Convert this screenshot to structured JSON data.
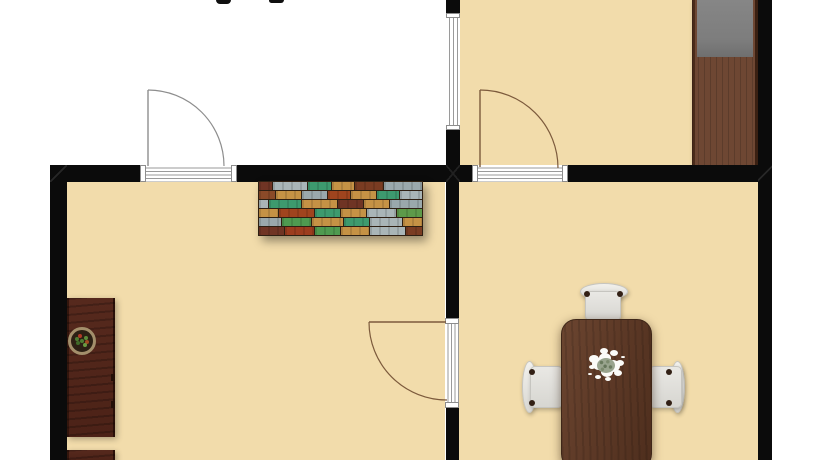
{
  "meta": {
    "description": "Top-down 2D architectural floor plan rendering, cropped at the top and bottom edges",
    "label_note": "only two tiny descender fragments of a cropped room-label text are visible at the very top edge"
  },
  "colors": {
    "background": "#ffffff",
    "floor": "#f2dcab",
    "wall": "#0b0b0b",
    "door-line-gray": "#8d8d8d",
    "door-line-brown": "#7c5a3c",
    "threshold-line": "#9a9a9a",
    "wardrobe-body": "#6e4733",
    "wardrobe-top": "#7d7d7d",
    "cabinet": "#56291d",
    "table": "#5e3a27",
    "table-edge": "#3f2718",
    "chair-edge": "#c6c5c0",
    "chair-dot": "#322015",
    "plant-rim": "#a38f6b",
    "plant-soil": "#2c2014",
    "centerpiece-white": "#fbfbf8",
    "centerpiece-core": "#99a48e"
  },
  "rooms": [
    {
      "id": "top-left-room",
      "floor": "white",
      "contents": []
    },
    {
      "id": "top-right-room",
      "floor": "tan",
      "contents": [
        "wardrobe"
      ]
    },
    {
      "id": "bottom-left-room",
      "floor": "tan",
      "contents": [
        "multicolor-sideboard",
        "tall-cabinet",
        "potted-plant",
        "lower-cabinet"
      ]
    },
    {
      "id": "bottom-right-room",
      "floor": "tan",
      "contents": [
        "dining-table",
        "three-chairs",
        "flower-centerpiece"
      ]
    }
  ],
  "openings": {
    "doors": [
      {
        "id": "door-top-left",
        "wall": "middle-horizontal-wall",
        "swing": "opens up into white room"
      },
      {
        "id": "door-top-right",
        "wall": "middle-horizontal-wall",
        "swing": "opens up into top-right room"
      },
      {
        "id": "door-bottom-middle",
        "wall": "vertical-divider-wall",
        "swing": "opens left into bottom-left room"
      }
    ],
    "windows": [
      {
        "id": "window-upper-divider",
        "wall": "upper-vertical-divider-wall"
      }
    ]
  },
  "furniture": {
    "wardrobe": {
      "room": "top-right-room",
      "style": "dark wood with gray top panel, flush against right wall"
    },
    "sideboard": {
      "room": "bottom-left-room",
      "style": "reclaimed multicolor wood planks, against middle wall",
      "plank_rows": [
        [
          {
            "c": "#6f3424",
            "w": 8
          },
          {
            "c": "#a9b5b7",
            "w": 22
          },
          {
            "c": "#3d9a6e",
            "w": 14
          },
          {
            "c": "#c59245",
            "w": 14
          },
          {
            "c": "#7a3c22",
            "w": 18
          },
          {
            "c": "#9aa8ac",
            "w": 24
          }
        ],
        [
          {
            "c": "#8a4a28",
            "w": 10
          },
          {
            "c": "#c59245",
            "w": 16
          },
          {
            "c": "#9aa8ac",
            "w": 16
          },
          {
            "c": "#a0441e",
            "w": 14
          },
          {
            "c": "#c59245",
            "w": 16
          },
          {
            "c": "#3d9a6e",
            "w": 14
          },
          {
            "c": "#a9b5b7",
            "w": 14
          }
        ],
        [
          {
            "c": "#a9b5b7",
            "w": 6
          },
          {
            "c": "#3d9a6e",
            "w": 20
          },
          {
            "c": "#c59245",
            "w": 22
          },
          {
            "c": "#6f3424",
            "w": 16
          },
          {
            "c": "#c59245",
            "w": 16
          },
          {
            "c": "#9aa8ac",
            "w": 20
          }
        ],
        [
          {
            "c": "#c59245",
            "w": 12
          },
          {
            "c": "#a0441e",
            "w": 22
          },
          {
            "c": "#3d9a6e",
            "w": 16
          },
          {
            "c": "#c59245",
            "w": 16
          },
          {
            "c": "#a9b5b7",
            "w": 18
          },
          {
            "c": "#5d9a4a",
            "w": 16
          }
        ],
        [
          {
            "c": "#9aa8ac",
            "w": 14
          },
          {
            "c": "#4e9a50",
            "w": 18
          },
          {
            "c": "#c59245",
            "w": 20
          },
          {
            "c": "#3d9a6e",
            "w": 16
          },
          {
            "c": "#a9b5b7",
            "w": 20
          },
          {
            "c": "#c59245",
            "w": 12
          }
        ],
        [
          {
            "c": "#6f3424",
            "w": 16
          },
          {
            "c": "#9c3c1e",
            "w": 18
          },
          {
            "c": "#4e9a50",
            "w": 16
          },
          {
            "c": "#c59245",
            "w": 18
          },
          {
            "c": "#a9b5b7",
            "w": 22
          },
          {
            "c": "#7a3c22",
            "w": 10
          }
        ]
      ]
    },
    "tall_cabinet": {
      "room": "bottom-left-room",
      "style": "dark red-brown wood, along left wall"
    },
    "lower_cabinet": {
      "room": "bottom-left-room",
      "style": "dark red-brown wood, cut off at bottom edge"
    },
    "potted_plant": {
      "on": "tall_cabinet",
      "style": "round pot with green and red foliage"
    },
    "dining_table": {
      "room": "bottom-right-room",
      "style": "dark walnut, rounded corners, cut off at bottom edge"
    },
    "chairs": {
      "room": "bottom-right-room",
      "count": 3,
      "positions": [
        "top",
        "left",
        "right"
      ],
      "style": "white with dark fittings"
    },
    "centerpiece": {
      "on": "dining_table",
      "style": "white flower bouquet with gray-green core"
    }
  },
  "text_fragments": [
    {
      "id": "cropped-label-fragment-left"
    },
    {
      "id": "cropped-label-fragment-right"
    }
  ]
}
